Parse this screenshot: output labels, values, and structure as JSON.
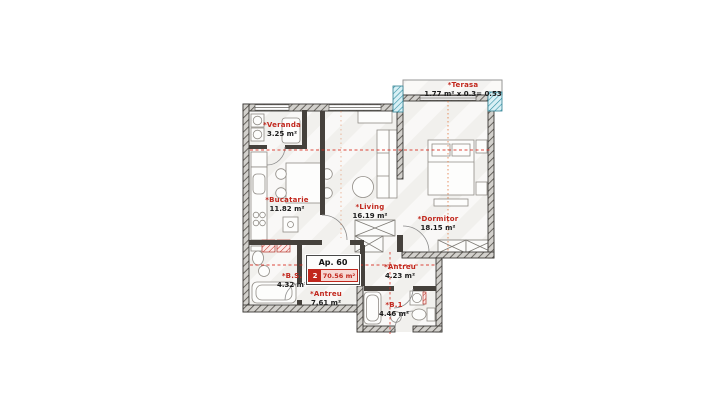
{
  "apartment": {
    "label": "Ap. 60",
    "rooms_count": "2",
    "total_area": "70.56 m²"
  },
  "rooms": [
    {
      "id": "veranda",
      "name": "*Veranda",
      "area": "3.25 m²"
    },
    {
      "id": "bucatarie",
      "name": "*Bucatarie",
      "area": "11.82 m²"
    },
    {
      "id": "living",
      "name": "*Living",
      "area": "16.19 m²"
    },
    {
      "id": "dormitor",
      "name": "*Dormitor",
      "area": "18.15 m²"
    },
    {
      "id": "bs",
      "name": "*B.S.",
      "area": "4.32 m²"
    },
    {
      "id": "antreu-1",
      "name": "*Antreu",
      "area": "7.61 m²"
    },
    {
      "id": "antreu-2",
      "name": "*Antreu",
      "area": "4.23 m²"
    },
    {
      "id": "b1",
      "name": "*B.1",
      "area": "4.46 m²"
    }
  ],
  "terrace": {
    "name": "*Terasa",
    "calc": "1.77 m² x 0.3= 0.53"
  },
  "colors": {
    "label_red": "#c1271d",
    "wall_dark": "#45413c",
    "teal_accent": "#2e8fa3"
  }
}
